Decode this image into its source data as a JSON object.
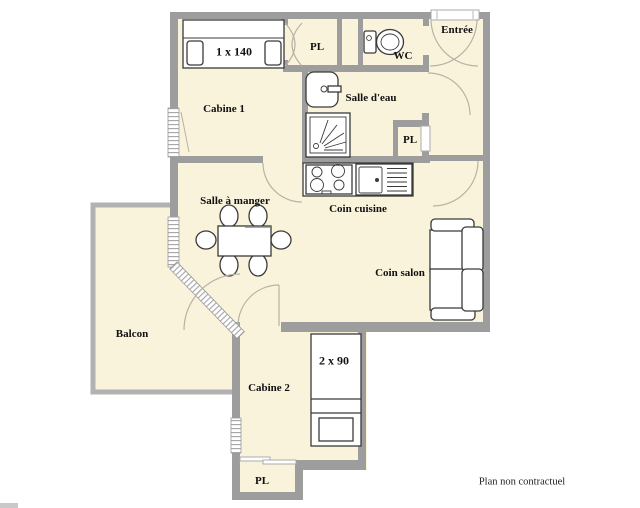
{
  "plan": {
    "footer": "Plan non contractuel",
    "rooms": {
      "cabine1": "Cabine 1",
      "pl_top": "PL",
      "wc": "WC",
      "entree": "Entrée",
      "salle_eau": "Salle d'eau",
      "pl_corridor": "PL",
      "salle_a_manger": "Salle à manger",
      "coin_cuisine": "Coin cuisine",
      "coin_salon": "Coin salon",
      "balcon": "Balcon",
      "cabine2": "Cabine 2",
      "pl_bottom": "PL"
    },
    "furniture_labels": {
      "bed_double": "1 x 140",
      "bed_bunk": "2 x 90"
    },
    "colors": {
      "wall": "#9d9d9d",
      "floor": "#faf3dc",
      "balcony_border": "#b2b2b2",
      "furniture_stroke": "#3a3a3a",
      "door_arc": "#b9b2a4"
    }
  }
}
